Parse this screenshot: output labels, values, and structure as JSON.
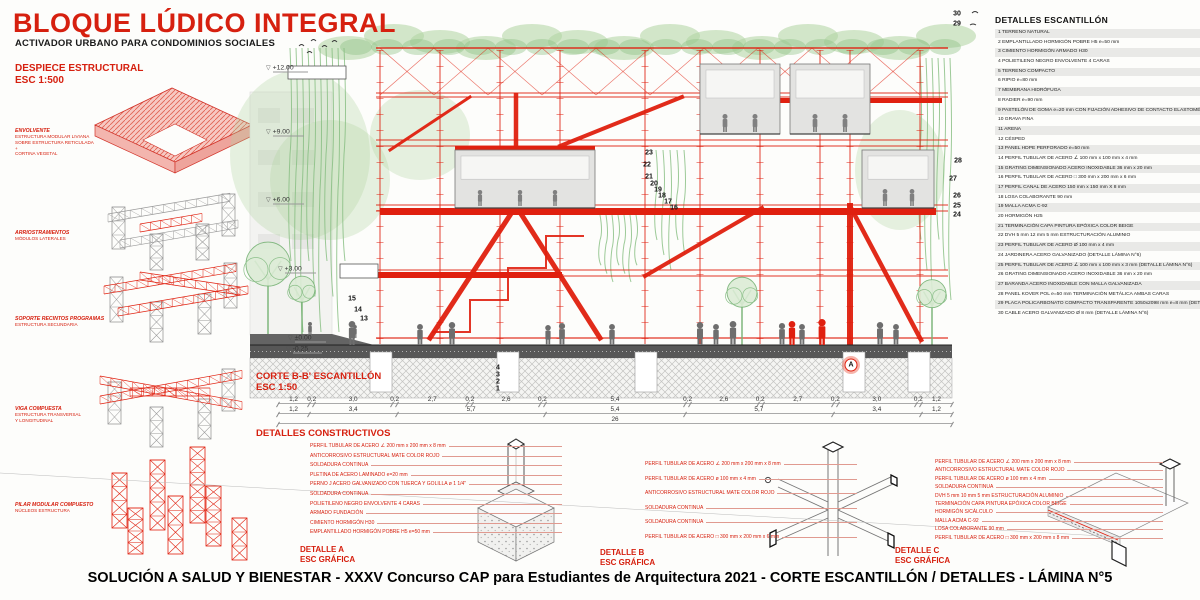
{
  "header": {
    "title": "BLOQUE LÚDICO INTEGRAL",
    "subtitle": "ACTIVADOR URBANO PARA CONDOMINIOS SOCIALES"
  },
  "despiece": {
    "title": "DESPIECE ESTRUCTURAL\nESC 1:500",
    "items": [
      {
        "label": "ENVOLVENTE",
        "desc": "ESTRUCTURA MODULAR LIVIANA\nSOBRE ESTRUCTURA RETICULADA\n+\nCORTINA VEGETAL"
      },
      {
        "label": "ARRIOSTRAMIENTOS",
        "desc": "MÓDULOS LATERALES"
      },
      {
        "label": "SOPORTE RECINTOS PROGRAMAS",
        "desc": "ESTRUCTURA SECUNDARIA"
      },
      {
        "label": "VIGA COMPUESTA",
        "desc": "ESTRUCTURA TRANSVERSAL\nY LONGITUDINAL"
      },
      {
        "label": "PILAR MODULAR COMPUESTO",
        "desc": "NÚCLEOS ESTRUCTURA"
      }
    ]
  },
  "section": {
    "title": "CORTE B-B' ESCANTILLÓN\nESC 1:50",
    "levels": [
      {
        "label": "+12.00",
        "x": 266,
        "y": 68
      },
      {
        "label": "+9.00",
        "x": 266,
        "y": 132
      },
      {
        "label": "+6.00",
        "x": 266,
        "y": 200
      },
      {
        "label": "+3.00",
        "x": 278,
        "y": 269
      },
      {
        "label": "±0.00",
        "x": 288,
        "y": 338
      },
      {
        "label": "-0.25",
        "x": 286,
        "y": 349
      }
    ],
    "callouts": [
      {
        "n": "30",
        "x": 957,
        "y": 14
      },
      {
        "n": "29",
        "x": 957,
        "y": 24
      },
      {
        "n": "28",
        "x": 958,
        "y": 161
      },
      {
        "n": "27",
        "x": 953,
        "y": 179
      },
      {
        "n": "26",
        "x": 957,
        "y": 196
      },
      {
        "n": "25",
        "x": 957,
        "y": 206
      },
      {
        "n": "24",
        "x": 957,
        "y": 215
      },
      {
        "n": "23",
        "x": 649,
        "y": 153
      },
      {
        "n": "22",
        "x": 647,
        "y": 165
      },
      {
        "n": "21",
        "x": 649,
        "y": 177
      },
      {
        "n": "20",
        "x": 654,
        "y": 184
      },
      {
        "n": "19",
        "x": 658,
        "y": 190
      },
      {
        "n": "18",
        "x": 662,
        "y": 196
      },
      {
        "n": "17",
        "x": 668,
        "y": 202
      },
      {
        "n": "16",
        "x": 674,
        "y": 208
      },
      {
        "n": "15",
        "x": 352,
        "y": 299
      },
      {
        "n": "14",
        "x": 358,
        "y": 310
      },
      {
        "n": "13",
        "x": 364,
        "y": 319
      },
      {
        "n": "4",
        "x": 498,
        "y": 368
      },
      {
        "n": "3",
        "x": 498,
        "y": 375
      },
      {
        "n": "2",
        "x": 498,
        "y": 382
      },
      {
        "n": "1",
        "x": 498,
        "y": 389
      },
      {
        "n": "A",
        "x": 851,
        "y": 365,
        "circled": true
      }
    ],
    "dimensions": {
      "row1": [
        "1,2",
        "0,2",
        "3,0",
        "0,2",
        "2,7",
        "0,2",
        "2,6",
        "0,2",
        "5,4",
        "0,2",
        "2,6",
        "0,2",
        "2,7",
        "0,2",
        "3,0",
        "0,2",
        "1,2"
      ],
      "row2": [
        "1,2",
        "3,4",
        "5,7",
        "5,4",
        "5,7",
        "3,4",
        "1,2"
      ],
      "row3": [
        "26"
      ]
    }
  },
  "legend": {
    "title": "DETALLES ESCANTILLÓN",
    "items": [
      {
        "n": "1",
        "text": "TERRENO NATURAL"
      },
      {
        "n": "2",
        "text": "EMPLANTILLADO HORMIGÓN POBRE H5 e=50 mm"
      },
      {
        "n": "3",
        "text": "CIMIENTO HORMIGÓN ARMADO H30"
      },
      {
        "n": "4",
        "text": "POLIETILENO NEGRO ENVOLVENTE 4 CARAS"
      },
      {
        "n": "5",
        "text": "TERRENO COMPACTO"
      },
      {
        "n": "6",
        "text": "RIPIO e=80 mm"
      },
      {
        "n": "7",
        "text": "MEMBRANA HIDRÓFUGA"
      },
      {
        "n": "8",
        "text": "RADIER e=90 mm"
      },
      {
        "n": "9",
        "text": "PASTELÓN DE GOMA e=20 mm CON FIJACIÓN ADHESIVO DE CONTACTO ELASTOMÉRICO"
      },
      {
        "n": "10",
        "text": "GRAVA FINA"
      },
      {
        "n": "11",
        "text": "ARENA"
      },
      {
        "n": "12",
        "text": "CÉSPED"
      },
      {
        "n": "13",
        "text": "PANEL HDPE PERFORADO e=50 mm"
      },
      {
        "n": "14",
        "text": "PERFIL TUBULAR DE ACERO ∠ 100 mm x 100 mm x 4 mm"
      },
      {
        "n": "15",
        "text": "GRATING DIMENSIONADO ACERO INOXIDABLE 36 mm x 20 mm"
      },
      {
        "n": "16",
        "text": "PERFIL TUBULAR DE ACERO □ 300 mm x 200 mm x 6 mm"
      },
      {
        "n": "17",
        "text": "PERFIL CANAL DE ACERO 150 mm x 150 mm X 8 mm"
      },
      {
        "n": "18",
        "text": "LOSA COLABORANTE 90 mm"
      },
      {
        "n": "19",
        "text": "MALLA ACMA C-92"
      },
      {
        "n": "20",
        "text": "HORMIGÓN H25"
      },
      {
        "n": "21",
        "text": "TERMINACIÓN CAPA PINTURA EPÓXICA COLOR BEIGE"
      },
      {
        "n": "22",
        "text": "DVH 5 mm 12 mm 5 mm ESTRUCTURACIÓN ALUMINIO"
      },
      {
        "n": "23",
        "text": "PERFIL TUBULAR DE ACERO Ø 100 mm x 4 mm"
      },
      {
        "n": "24",
        "text": "JARDINERA ACERO GALVANIZADO (DETALLE LÁMINA N°6)"
      },
      {
        "n": "25",
        "text": "PERFIL TUBULAR DE ACERO ∠ 100 mm x 100 mm x 3 mm (DETALLE LÁMINA N°6)"
      },
      {
        "n": "26",
        "text": "GRATING DIMENSIONADO ACERO INOXIDABLE 36 mm x 20 mm"
      },
      {
        "n": "27",
        "text": "BARANDA ACERO INOXIDABLE CON MALLA GALVANIZADA"
      },
      {
        "n": "28",
        "text": "PANEL KOVER POL e=50 mm  TERMINACIÓN METÁLICA AMBAS CARAS"
      },
      {
        "n": "29",
        "text": "PLACA POLICARBONATO COMPACTO TRANSPARENTE 1050x2098 mm e=8 mm (DETALLE LÁMINA N°6)"
      },
      {
        "n": "30",
        "text": "CABLE ACERO GALVANIZADO Ø 8 mm  (DETALLE LÁMINA N°6)"
      }
    ]
  },
  "details": {
    "title": "DETALLES CONSTRUCTIVOS",
    "a": {
      "label": "DETALLE A\nESC GRÁFICA",
      "annotations": [
        "PERFIL TUBULAR DE ACERO ∠ 200 mm x 200 mm x 8 mm",
        "ANTICORROSIVO ESTRUCTURAL MATE COLOR ROJO",
        "SOLDADURA CONTINUA",
        "PLETINA DE ACERO LAMINADO e=20 mm",
        "PERNO J ACERO GALVANIZADO CON TUERCA Y GOLILLA ø 1 1/4\"",
        "SOLDADURA CONTINUA",
        "POLIETILENO NEGRO ENVOLVENTE 4 CARAS",
        "ARMADO FUNDACIÓN",
        "CIMIENTO HORMIGÓN H30",
        "EMPLANTILLADO HORMIGÓN POBRE H5 e=50 mm"
      ]
    },
    "b": {
      "label": "DETALLE B\nESC GRÁFICA",
      "annotations": [
        "PERFIL TUBULAR DE ACERO ∠ 200 mm x 200 mm x 8 mm",
        "PERFIL TUBULAR DE ACERO ø 100 mm x 4 mm",
        "ANTICORROSIVO ESTRUCTURAL MATE COLOR ROJO",
        "SOLDADURA CONTINUA",
        "SOLDADURA CONTINUA",
        "PERFIL TUBULAR DE ACERO □ 300 mm x 200 mm x 6 mm"
      ]
    },
    "c": {
      "label": "DETALLE C\nESC GRÁFICA",
      "annotations": [
        "PERFIL TUBULAR DE ACERO ∠ 200 mm x 200 mm x 8 mm",
        "ANTICORROSIVO ESTRUCTURAL MATE COLOR ROJO",
        "PERFIL TUBULAR DE ACERO ø 100 mm x 4 mm",
        "SOLDADURA CONTINUA",
        "DVH 5 mm 10 mm 5 mm ESTRUCTURACIÓN ALUMINIO",
        "TERMINACIÓN CAPA PINTURA EPÓXICA COLOR BEIGE",
        "HORMIGÓN S/CÁLCULO",
        "MALLA ACMA C-92",
        "LOSA COLABORANTE 90 mm",
        "PERFIL TUBULAR DE ACERO □ 300 mm x 200 mm x 8 mm"
      ]
    }
  },
  "footer": {
    "title": "SOLUCIÓN A SALUD Y BIENESTAR - XXXV Concurso CAP para Estudiantes de Arquitectura 2021 - CORTE ESCANTILLÓN / DETALLES - LÁMINA N°5"
  },
  "colors": {
    "red": "#e0200f",
    "title_red": "#d6200f",
    "structure_gray": "#9a9a9a",
    "green_light": "#aed3a0",
    "green_mid": "#85bd7f",
    "ground_dark": "#575757",
    "legend_zebra": "#e9e9e7"
  }
}
